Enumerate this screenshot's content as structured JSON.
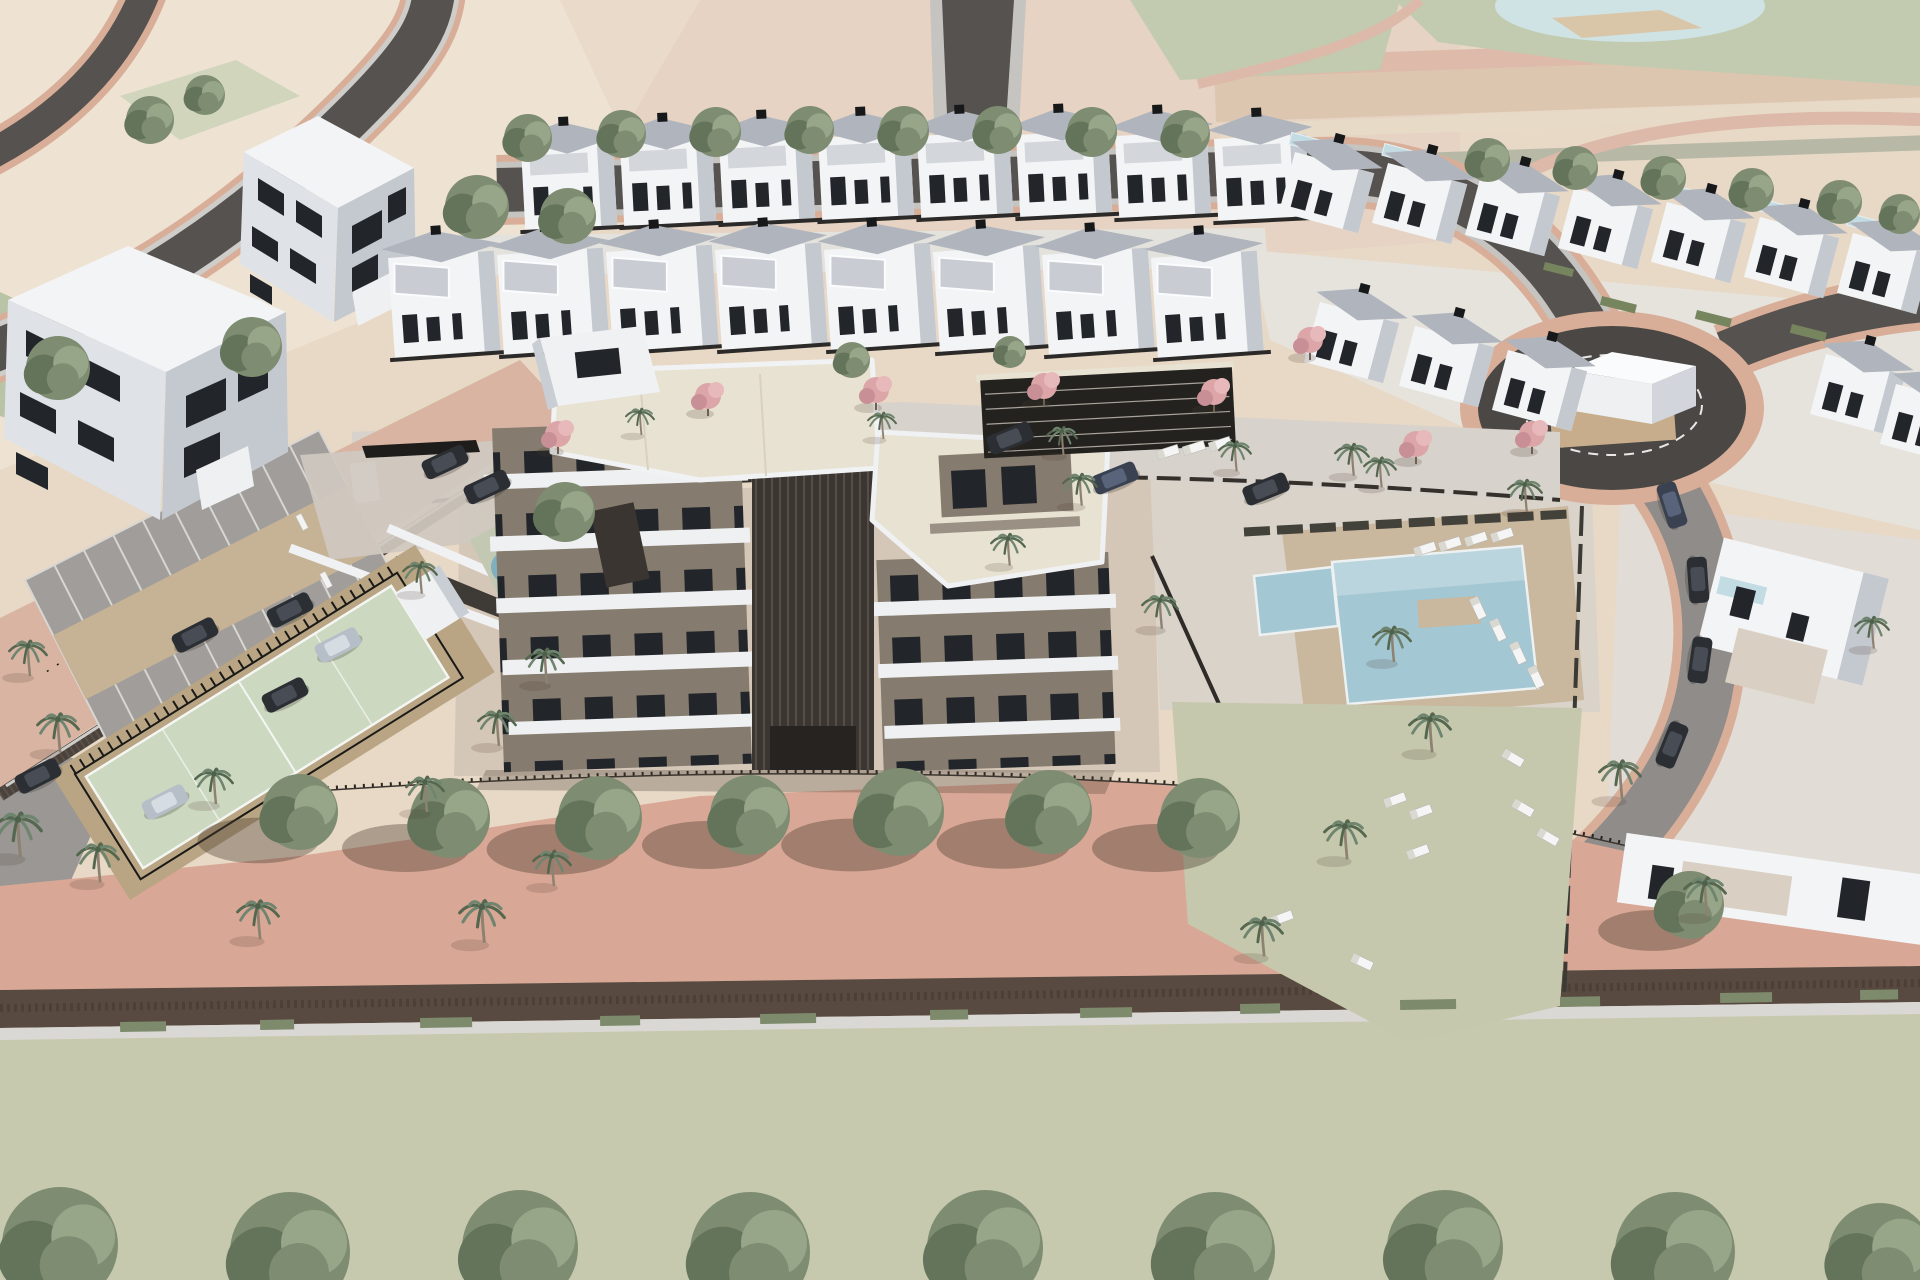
{
  "meta": {
    "description": "aerial 3d architectural render of a residential development with apartment block, townhouse rows, pools, tennis court and parking"
  },
  "palette": {
    "bgBeige": "#e8d8c6",
    "bgPale": "#eee3d3",
    "bgPink": "#e5cebe",
    "sage": "#c2cbb0",
    "pond": "#cfe3e4",
    "sand": "#d9c5a8",
    "asphalt": "#56524f",
    "asphaltDark": "#4b4745",
    "roadPink": "#d9ae99",
    "sidewalk": "#c6c4c0",
    "streetPink": "#d9b4a2",
    "bandPink": "#d9a795",
    "pavers": "#d7d2cb",
    "cobble": "#cfc9c0",
    "white": "#f3f4f6",
    "facadeLight": "#dfe2e6",
    "facadeShade": "#c4c8cf",
    "facadeDark": "#9ba1ab",
    "roofGray": "#b0b5bd",
    "window": "#22252a",
    "cream": "#e8e2d2",
    "taupe": "#857b6e",
    "brown": "#3b3631",
    "slat": "#544e46",
    "pool": "#a3c7d3",
    "poolLight": "#c3dce3",
    "deck": "#c9b79e",
    "lawn": "#c6c8ad",
    "court": "#cdd8c1",
    "courtApron": "#b9a583",
    "parkGray": "#a09d9a",
    "parkTan": "#c6b396",
    "tree1": "#7e8d71",
    "tree2": "#64745a",
    "treeLight": "#97a588",
    "palm": "#6f856f",
    "palmDark": "#55684f",
    "pinkTree": "#dca6a9",
    "pinkTreeDark": "#c98f96",
    "carDark": "#2b2e33",
    "carSilver": "#b6bfc8",
    "carBlue": "#3a4252",
    "hedge": "#4a463c",
    "hedgeBrown": "#584a40",
    "wallLight": "#d9d8d5",
    "fence": "#23211e",
    "shadow": "rgba(74,60,48,0.38)"
  },
  "scene": {
    "trees": [
      {
        "x": 528,
        "y": 138,
        "r": 24
      },
      {
        "x": 622,
        "y": 134,
        "r": 24
      },
      {
        "x": 716,
        "y": 132,
        "r": 25
      },
      {
        "x": 810,
        "y": 130,
        "r": 24
      },
      {
        "x": 904,
        "y": 131,
        "r": 25
      },
      {
        "x": 998,
        "y": 130,
        "r": 24
      },
      {
        "x": 1092,
        "y": 132,
        "r": 25
      },
      {
        "x": 1186,
        "y": 134,
        "r": 24
      },
      {
        "x": 1488,
        "y": 160,
        "r": 22
      },
      {
        "x": 1576,
        "y": 168,
        "r": 22
      },
      {
        "x": 1664,
        "y": 178,
        "r": 22
      },
      {
        "x": 1752,
        "y": 190,
        "r": 22
      },
      {
        "x": 1840,
        "y": 202,
        "r": 22
      },
      {
        "x": 1900,
        "y": 214,
        "r": 20
      },
      {
        "x": 477,
        "y": 207,
        "r": 32
      },
      {
        "x": 568,
        "y": 216,
        "r": 28
      },
      {
        "x": 252,
        "y": 347,
        "r": 30
      },
      {
        "x": 58,
        "y": 368,
        "r": 32
      },
      {
        "x": 150,
        "y": 120,
        "r": 24
      },
      {
        "x": 205,
        "y": 95,
        "r": 20
      },
      {
        "x": 565,
        "y": 512,
        "r": 30
      },
      {
        "x": 852,
        "y": 360,
        "r": 18
      },
      {
        "x": 1010,
        "y": 352,
        "r": 16
      },
      {
        "x": 300,
        "y": 812,
        "r": 38,
        "sh": 1
      },
      {
        "x": 450,
        "y": 818,
        "r": 40,
        "sh": 1
      },
      {
        "x": 600,
        "y": 818,
        "r": 42,
        "sh": 1
      },
      {
        "x": 750,
        "y": 815,
        "r": 40,
        "sh": 1
      },
      {
        "x": 900,
        "y": 812,
        "r": 44,
        "sh": 1
      },
      {
        "x": 1050,
        "y": 812,
        "r": 42,
        "sh": 1
      },
      {
        "x": 1200,
        "y": 818,
        "r": 40,
        "sh": 1
      },
      {
        "x": 1690,
        "y": 905,
        "r": 34,
        "sh": 1
      },
      {
        "x": 60,
        "y": 1245,
        "r": 58
      },
      {
        "x": 290,
        "y": 1252,
        "r": 60
      },
      {
        "x": 520,
        "y": 1248,
        "r": 58
      },
      {
        "x": 750,
        "y": 1252,
        "r": 60
      },
      {
        "x": 985,
        "y": 1248,
        "r": 58
      },
      {
        "x": 1215,
        "y": 1252,
        "r": 60
      },
      {
        "x": 1445,
        "y": 1248,
        "r": 58
      },
      {
        "x": 1675,
        "y": 1252,
        "r": 60
      },
      {
        "x": 1880,
        "y": 1255,
        "r": 52
      }
    ],
    "palms": [
      {
        "x": 28,
        "y": 672,
        "s": 1.0
      },
      {
        "x": 58,
        "y": 748,
        "s": 1.1
      },
      {
        "x": 18,
        "y": 852,
        "s": 1.25
      },
      {
        "x": 98,
        "y": 878,
        "s": 1.1
      },
      {
        "x": 214,
        "y": 800,
        "s": 1.0
      },
      {
        "x": 258,
        "y": 935,
        "s": 1.1
      },
      {
        "x": 425,
        "y": 808,
        "s": 1.0
      },
      {
        "x": 482,
        "y": 938,
        "s": 1.2
      },
      {
        "x": 552,
        "y": 882,
        "s": 1.0
      },
      {
        "x": 420,
        "y": 590,
        "s": 0.9
      },
      {
        "x": 545,
        "y": 680,
        "s": 1.0
      },
      {
        "x": 497,
        "y": 742,
        "s": 1.0
      },
      {
        "x": 640,
        "y": 432,
        "s": 0.75
      },
      {
        "x": 882,
        "y": 436,
        "s": 0.75
      },
      {
        "x": 1062,
        "y": 452,
        "s": 0.8
      },
      {
        "x": 1235,
        "y": 468,
        "s": 0.85
      },
      {
        "x": 1380,
        "y": 484,
        "s": 0.85
      },
      {
        "x": 1352,
        "y": 472,
        "s": 0.9
      },
      {
        "x": 1525,
        "y": 508,
        "s": 0.9
      },
      {
        "x": 1392,
        "y": 658,
        "s": 1.0
      },
      {
        "x": 1430,
        "y": 748,
        "s": 1.1
      },
      {
        "x": 1080,
        "y": 502,
        "s": 0.9
      },
      {
        "x": 1008,
        "y": 562,
        "s": 0.9
      },
      {
        "x": 1160,
        "y": 625,
        "s": 0.95
      },
      {
        "x": 1345,
        "y": 855,
        "s": 1.1
      },
      {
        "x": 1620,
        "y": 795,
        "s": 1.1
      },
      {
        "x": 1705,
        "y": 912,
        "s": 1.1
      },
      {
        "x": 1262,
        "y": 952,
        "s": 1.1
      },
      {
        "x": 1872,
        "y": 645,
        "s": 0.9
      }
    ],
    "pinkTrees": [
      {
        "x": 558,
        "y": 442
      },
      {
        "x": 708,
        "y": 404
      },
      {
        "x": 876,
        "y": 398
      },
      {
        "x": 1044,
        "y": 394
      },
      {
        "x": 1214,
        "y": 400
      },
      {
        "x": 1310,
        "y": 348
      },
      {
        "x": 1416,
        "y": 452
      },
      {
        "x": 1532,
        "y": 442
      }
    ],
    "cars": [
      {
        "x": 195,
        "y": 635,
        "r": -27,
        "c": "dark"
      },
      {
        "x": 290,
        "y": 610,
        "r": -27,
        "c": "dark"
      },
      {
        "x": 338,
        "y": 645,
        "r": -27,
        "c": "silver"
      },
      {
        "x": 285,
        "y": 695,
        "r": -27,
        "c": "dark"
      },
      {
        "x": 38,
        "y": 776,
        "r": -27,
        "c": "dark"
      },
      {
        "x": 165,
        "y": 802,
        "r": -27,
        "c": "silver"
      },
      {
        "x": 487,
        "y": 487,
        "r": -25,
        "c": "dark"
      },
      {
        "x": 445,
        "y": 462,
        "r": -25,
        "c": "dark"
      },
      {
        "x": 1010,
        "y": 438,
        "r": -22,
        "c": "dark"
      },
      {
        "x": 1115,
        "y": 478,
        "r": -22,
        "c": "blue"
      },
      {
        "x": 1266,
        "y": 489,
        "r": -22,
        "c": "dark"
      },
      {
        "x": 1672,
        "y": 505,
        "r": 72,
        "c": "blue"
      },
      {
        "x": 1698,
        "y": 580,
        "r": 86,
        "c": "dark"
      },
      {
        "x": 1700,
        "y": 660,
        "r": 98,
        "c": "dark"
      },
      {
        "x": 1672,
        "y": 745,
        "r": 112,
        "c": "dark"
      }
    ],
    "loungers": [
      {
        "x": 1425,
        "y": 549,
        "r": -18
      },
      {
        "x": 1450,
        "y": 544,
        "r": -18
      },
      {
        "x": 1476,
        "y": 539,
        "r": -18
      },
      {
        "x": 1502,
        "y": 535,
        "r": -18
      },
      {
        "x": 1168,
        "y": 452,
        "r": -18
      },
      {
        "x": 1194,
        "y": 448,
        "r": -18
      },
      {
        "x": 1220,
        "y": 444,
        "r": -18
      },
      {
        "x": 1478,
        "y": 608,
        "r": 65
      },
      {
        "x": 1498,
        "y": 630,
        "r": 65
      },
      {
        "x": 1518,
        "y": 653,
        "r": 65
      },
      {
        "x": 1536,
        "y": 677,
        "r": 65
      },
      {
        "x": 1513,
        "y": 758,
        "r": 30
      },
      {
        "x": 1395,
        "y": 800,
        "r": -20
      },
      {
        "x": 1421,
        "y": 812,
        "r": -20
      },
      {
        "x": 1523,
        "y": 808,
        "r": 30
      },
      {
        "x": 1548,
        "y": 837,
        "r": 30
      },
      {
        "x": 1418,
        "y": 852,
        "r": -20
      },
      {
        "x": 1282,
        "y": 918,
        "r": -20
      },
      {
        "x": 1362,
        "y": 962,
        "r": 25
      }
    ],
    "benches": [
      {
        "x": 302,
        "y": 522,
        "r": 63
      },
      {
        "x": 326,
        "y": 580,
        "r": 63
      },
      {
        "x": 350,
        "y": 638,
        "r": 63
      }
    ],
    "hedges": [
      {
        "x": 1602,
        "y": 296,
        "w": 36,
        "h": 9,
        "r": 14
      },
      {
        "x": 1697,
        "y": 310,
        "w": 36,
        "h": 9,
        "r": 14
      },
      {
        "x": 1792,
        "y": 324,
        "w": 36,
        "h": 9,
        "r": 14
      },
      {
        "x": 1545,
        "y": 262,
        "w": 30,
        "h": 8,
        "r": 14
      },
      {
        "x": 120,
        "y": 1022,
        "w": 46,
        "h": 10,
        "r": -1,
        "c": "#7e8a6c"
      },
      {
        "x": 260,
        "y": 1020,
        "w": 34,
        "h": 10,
        "r": -1,
        "c": "#7e8a6c"
      },
      {
        "x": 420,
        "y": 1018,
        "w": 52,
        "h": 10,
        "r": -1,
        "c": "#7e8a6c"
      },
      {
        "x": 600,
        "y": 1016,
        "w": 40,
        "h": 10,
        "r": -1,
        "c": "#7e8a6c"
      },
      {
        "x": 760,
        "y": 1014,
        "w": 56,
        "h": 10,
        "r": -1,
        "c": "#7e8a6c"
      },
      {
        "x": 930,
        "y": 1010,
        "w": 38,
        "h": 10,
        "r": -1,
        "c": "#7e8a6c"
      },
      {
        "x": 1080,
        "y": 1008,
        "w": 52,
        "h": 10,
        "r": -1,
        "c": "#7e8a6c"
      },
      {
        "x": 1240,
        "y": 1004,
        "w": 40,
        "h": 10,
        "r": -1,
        "c": "#7e8a6c"
      },
      {
        "x": 1400,
        "y": 1000,
        "w": 56,
        "h": 10,
        "r": -1,
        "c": "#7e8a6c"
      },
      {
        "x": 1560,
        "y": 997,
        "w": 40,
        "h": 10,
        "r": -1,
        "c": "#7e8a6c"
      },
      {
        "x": 1720,
        "y": 993,
        "w": 52,
        "h": 10,
        "r": -1,
        "c": "#7e8a6c"
      },
      {
        "x": 1860,
        "y": 990,
        "w": 38,
        "h": 10,
        "r": -1,
        "c": "#7e8a6c"
      }
    ],
    "villasRowA": [
      {
        "x": 521,
        "y": 148
      },
      {
        "x": 620,
        "y": 144
      },
      {
        "x": 719,
        "y": 141
      },
      {
        "x": 818,
        "y": 138
      },
      {
        "x": 917,
        "y": 136
      },
      {
        "x": 1016,
        "y": 135
      },
      {
        "x": 1115,
        "y": 136
      },
      {
        "x": 1214,
        "y": 139
      }
    ],
    "villasRowB": [
      {
        "x": 388,
        "y": 258
      },
      {
        "x": 497,
        "y": 255
      },
      {
        "x": 606,
        "y": 252
      },
      {
        "x": 715,
        "y": 250
      },
      {
        "x": 824,
        "y": 250
      },
      {
        "x": 933,
        "y": 252
      },
      {
        "x": 1042,
        "y": 255
      },
      {
        "x": 1151,
        "y": 258
      }
    ],
    "villasRight": [
      {
        "x": 1295,
        "y": 152,
        "p": 1
      },
      {
        "x": 1388,
        "y": 163,
        "p": 1
      },
      {
        "x": 1481,
        "y": 175,
        "p": 1
      },
      {
        "x": 1574,
        "y": 188,
        "p": 1
      },
      {
        "x": 1667,
        "y": 202,
        "p": 1
      },
      {
        "x": 1760,
        "y": 217,
        "p": 1
      },
      {
        "x": 1853,
        "y": 233,
        "p": 1
      },
      {
        "x": 1320,
        "y": 302,
        "p": 0
      },
      {
        "x": 1415,
        "y": 326,
        "p": 0
      },
      {
        "x": 1508,
        "y": 350,
        "p": 0
      },
      {
        "x": 1826,
        "y": 354,
        "p": 0
      },
      {
        "x": 1896,
        "y": 384,
        "p": 0
      }
    ],
    "parking": {
      "x": 25,
      "y": 580,
      "rot": -27,
      "w": 330,
      "stallW": 33,
      "rowH": 62,
      "aisleH": 72
    }
  }
}
